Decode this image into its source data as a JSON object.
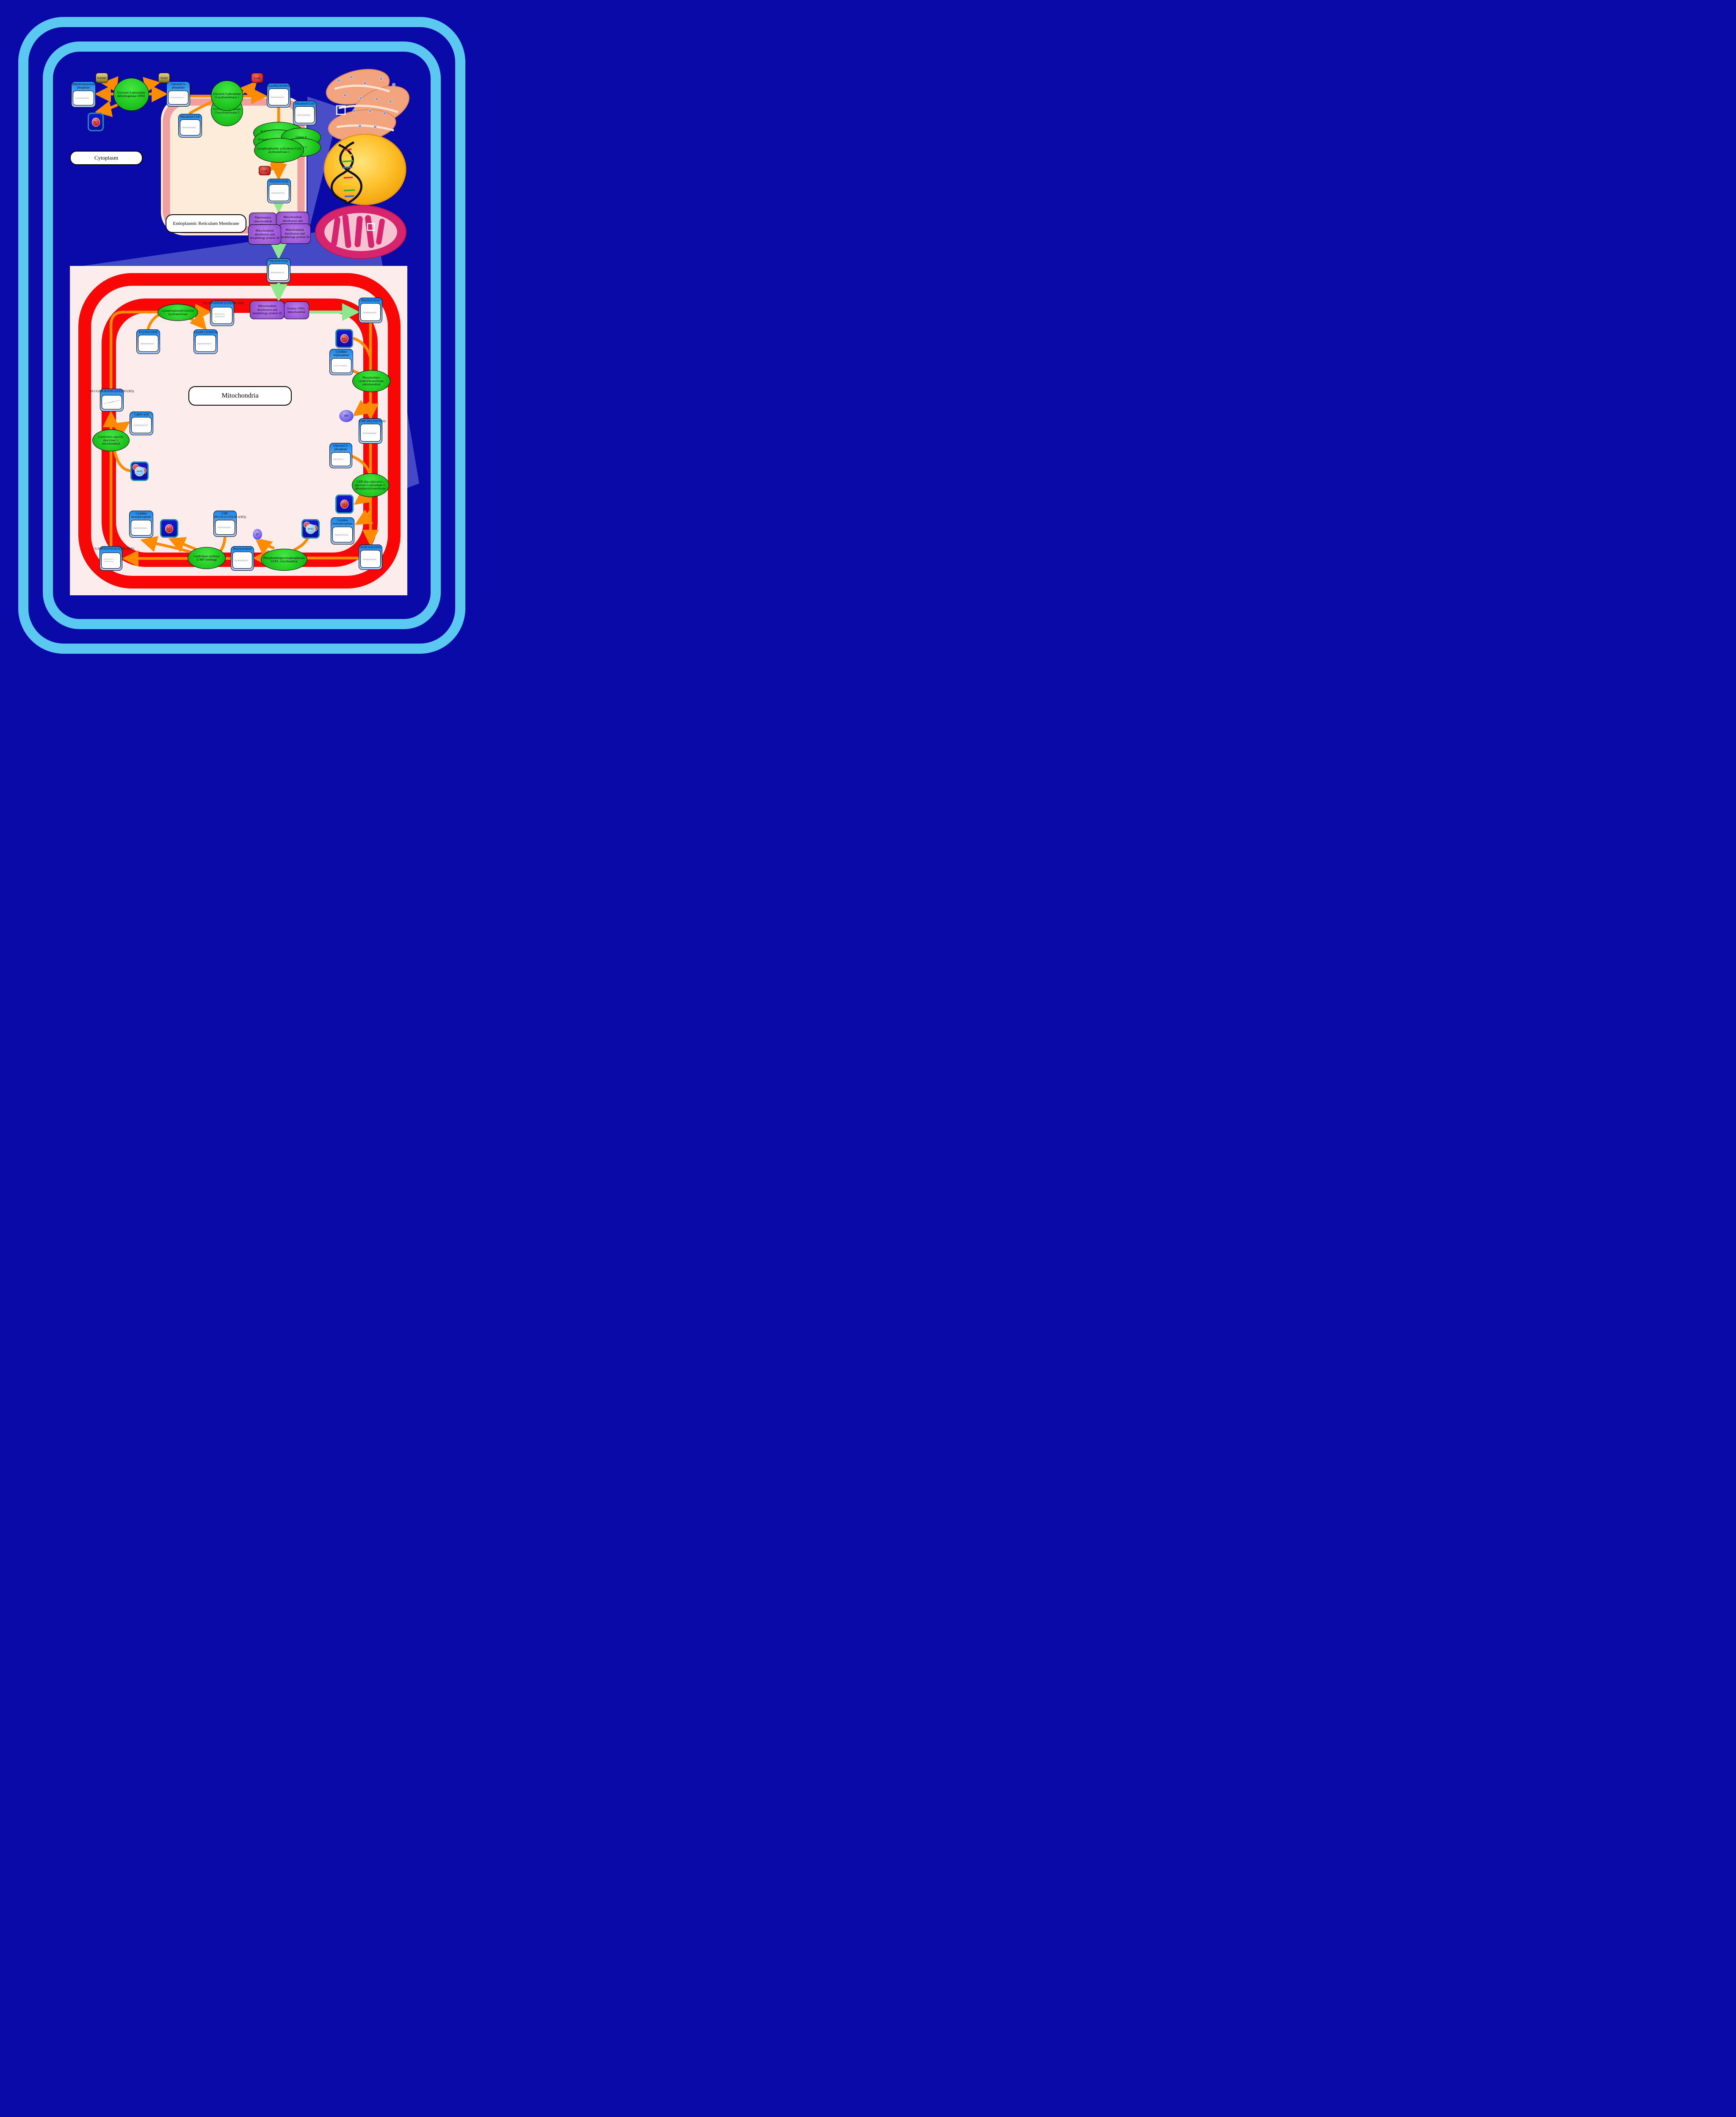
{
  "region_labels": {
    "cytoplasm": "Cytoplasm",
    "er_membrane": "Endoplasmic Reticulum Membrane",
    "mitochondria": "Mitochondria"
  },
  "metabolites": {
    "dhap": "Dihydroxyacetone phosphate",
    "g3p": "Glycerol 3-phosphate",
    "decanoyl_coa_er": "Decanoyl-CoA",
    "decanoyl_coa_right": "Decanoyl-CoA",
    "lysopa": "LysoPA(10:0/0:0)",
    "pa_er": "PA(10:0/10:0)",
    "pa_mid": "PA(10:0/10:0)",
    "pa_mito": "PA(10:0/10:0)",
    "cl_top": "CL(10:0/10:0/18:1(11Z)/28:1(9Z))",
    "pc": "PC(10:0/10:0)",
    "lysopc": "LysoPC(10:0/0:0)",
    "ctp": "Cytidine triphosphate",
    "cdpdg": "CDP-DG(10:0/10:0)",
    "g3p_mito": "Glycerol 3-phosphate",
    "cmp_right": "Cytidine monophosphate",
    "pgp": "PGP(10:0/10:0)",
    "pg": "PG(10:0/10:0)",
    "cdpdg181_line1": "CDP-",
    "cdpdg181_line2": "DG(18:1(11Z)/28:1(9Z))",
    "cmp_left": "Cytidine monophosphate",
    "cl_bottom": "CL(10:0/10:0/18:1(11Z)/28:1(9Z))",
    "mlcl": "MLCL(0:0/10:0/18:1(11Z)/28:1(9Z))",
    "capric_acid": "Capric acid"
  },
  "enzymes": {
    "gpd2": "Glycerol-3-phosphate dehydrogenase GPD2",
    "gpat1": "Glycerol-3-phosphate O-acyltransferase 1",
    "gpat2": "Glycerol-3-phosphate O-acyltransferase 2",
    "acyl_coa_lyso": "Acyl-CoA:lyso-phospholipid acyltransferase",
    "probable_agpat": "Probable 1-acyl-sn-glycerol-3-phosphate acyltransferase",
    "lipase4": "Lipase 4",
    "lipase5": "Lipase 5",
    "lpaat1": "Lysophosphatidic acid:oleoyl-CoA acyltransferase 1",
    "lpcat": "Lysophosphatidylcholine acyltransferase",
    "pa_cytidylyltransferase": "Phosphatidate cytidylyltransferase, mitochondrial",
    "cdp_dag_g3p_transferase": "CDP-diacylglycerol--glycerol-3-phosphate 3-phosphatidyltransferase",
    "cl_deacylase": "Cardiolipin-specific deacylase 1, mitochondrial",
    "cl_synthase": "Cardiolipin synthase (CMP-forming)",
    "gep4": "Phosphatidylglycerophosphatase GEP4, mitochondrial"
  },
  "proteins": {
    "mmm1": "Maintenance mitochondrial morphology",
    "mdm": "Mitochondrial distribution and morphology",
    "mdm34": "Mitochondrial distribution and morphology protein 34",
    "mdm10": "Mitochondrial distribution and morphology protein 10",
    "mdm35": "Mitochondrial distribution and morphology protein 35",
    "ups1": "Protein UPS1, mitochondrial"
  },
  "cofactors": {
    "nadh": "NADH",
    "nad": "NAD",
    "coa1": "CoA",
    "coa2": "CoA",
    "h_base": "H",
    "h_sup": "+",
    "h2o_p1": "H",
    "h2o_sub": "2",
    "h2o_p2": "O",
    "pi_base": "P",
    "pi_sub": "i",
    "ppi_base": "PP",
    "ppi_sub": "i"
  },
  "colors": {
    "background": "#0a0aa8",
    "cell_frame_blue": "#5ac8f0",
    "er_fill": "#fcecd9",
    "er_band_salmon": "#ef9f9f",
    "mito_fill": "#fdecec",
    "membrane_red": "#f90606",
    "arrow_orange": "#ff8c00",
    "arrow_green": "#8de88d",
    "enzyme_green": "#1dc41d",
    "protein_purple": "#9a53d4",
    "node_header_blue": "#1d86e8"
  }
}
